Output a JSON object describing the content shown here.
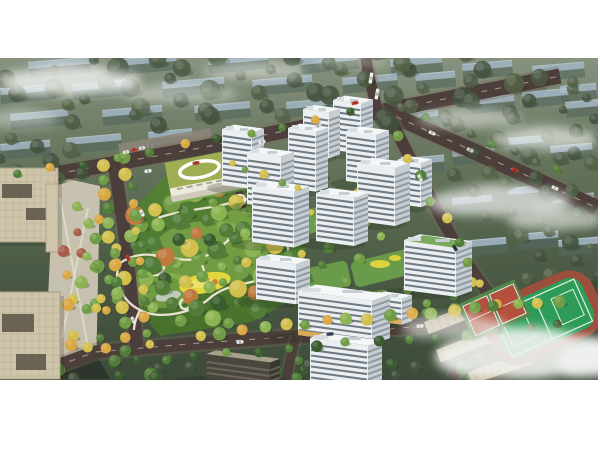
{
  "scene": {
    "description": "Aerial masterplan rendering: white residential towers around garden courtyards, central park with winding paths and yellow playground, kindergarten with green roof, beige office towers, sports field with red courts, tree-lined roads, faded background housing blocks and fog"
  },
  "canvas": {
    "w": 600,
    "h": 450,
    "bg": "#ffffff"
  },
  "render_frame": {
    "x": 0,
    "y": 58,
    "w": 598,
    "h": 322
  },
  "palette": {
    "fog": "#f2f4f2",
    "land": [
      "#87927f",
      "#64735a",
      "#4b5a44",
      "#3c4a39"
    ],
    "slabRoof": "#a7bccf",
    "slabRoofHi": "#d8e4ee",
    "slabFace": "#55675e",
    "road": "#4c3f3b",
    "curb": "#776a5b",
    "roadLine": "#e8ddca",
    "parkA": "#568336",
    "parkB": "#47702c",
    "lawn": "#7cae4b",
    "lawnHi": "#95c055",
    "path": "#efe9d9",
    "pond": "#c9cfc6",
    "playground": "#e4d63d",
    "playgroundHi": "#efe06a",
    "playOrange": "#d2823c",
    "towerFront": "#eceff1",
    "towerSide": "#c6cdd3",
    "towerRoof": "#f4f6f7",
    "stripe": "#414e59",
    "stripeSide": "#5a6670",
    "roofBox": "#d8dde1",
    "shop": "#d8a94f",
    "roofGarden": "#6da24b",
    "darkTop": "#a7a18c",
    "darkFront": "#4a463e",
    "darkSide": "#3a3731",
    "darkStripe": "#8d8674",
    "office": "#cfc5ab",
    "officeLine": "#b3a88d",
    "officeCourt": "#5f584a",
    "officeEdge": "#a89d83",
    "plaza": "#cdc6b4",
    "plazaPath": "#e7e2d4",
    "parking": "#8e867a",
    "schoolRoof": "#9fae52",
    "schoolWall": "#eeeadb",
    "schoolShade": "#cfcaba",
    "fieldGround": "#3d4c39",
    "fieldGreen": "#2e9b58",
    "fieldLine": "#dff0e4",
    "track": "#9c4f3c",
    "courtRed": "#b5503e",
    "courtGreen": "#56854a",
    "campusTop": "#c5b698",
    "campusFace": "#46423a",
    "shadow": "#1e2a1c",
    "darkStreet": "#2e352d",
    "trees": {
      "g1": "#3a5c2e",
      "g2": "#527d38",
      "g3": "#6f9c44",
      "g4": "#8cb452",
      "y": "#d2bf4e",
      "gold": "#d9a843",
      "o": "#bf7a3e",
      "r": "#a85c4a",
      "b1": "#44523e",
      "b2": "#556348",
      "b3": "#4d5c45"
    }
  },
  "bg_slabs": [
    [
      28,
      4,
      62
    ],
    [
      118,
      1,
      58
    ],
    [
      208,
      0,
      60
    ],
    [
      300,
      0,
      58
    ],
    [
      390,
      2,
      52
    ],
    [
      462,
      6,
      50
    ],
    [
      532,
      8,
      52
    ],
    [
      0,
      30,
      55
    ],
    [
      72,
      26,
      60
    ],
    [
      162,
      24,
      62
    ],
    [
      252,
      22,
      60
    ],
    [
      342,
      20,
      55
    ],
    [
      415,
      16,
      40
    ],
    [
      500,
      22,
      46
    ],
    [
      560,
      28,
      36
    ],
    [
      10,
      56,
      58
    ],
    [
      102,
      52,
      60
    ],
    [
      194,
      48,
      56
    ],
    [
      286,
      44,
      52
    ],
    [
      470,
      40,
      44
    ],
    [
      522,
      34,
      46
    ],
    [
      565,
      44,
      34
    ],
    [
      0,
      86,
      50
    ],
    [
      66,
      80,
      55
    ],
    [
      148,
      74,
      44
    ],
    [
      404,
      54,
      34
    ],
    [
      404,
      100,
      40
    ],
    [
      452,
      92,
      42
    ],
    [
      508,
      80,
      44
    ],
    [
      550,
      88,
      42
    ],
    [
      452,
      140,
      40
    ],
    [
      508,
      130,
      44
    ],
    [
      552,
      138,
      42
    ],
    [
      470,
      182,
      36
    ],
    [
      516,
      176,
      42
    ],
    [
      558,
      182,
      40
    ],
    [
      560,
      224,
      30
    ]
  ],
  "clouds": [
    [
      70,
      22,
      75,
      16,
      0.8
    ],
    [
      180,
      35,
      60,
      10,
      0.45
    ],
    [
      255,
      12,
      55,
      9,
      0.5
    ],
    [
      350,
      3,
      40,
      6,
      0.4
    ],
    [
      470,
      60,
      55,
      10,
      0.5
    ],
    [
      545,
      80,
      55,
      12,
      0.65
    ],
    [
      500,
      142,
      75,
      16,
      0.7
    ],
    [
      555,
      160,
      50,
      12,
      0.6
    ],
    [
      20,
      60,
      40,
      10,
      0.4
    ],
    [
      525,
      295,
      95,
      26,
      0.9
    ],
    [
      455,
      268,
      55,
      13,
      0.6
    ],
    [
      595,
      300,
      40,
      18,
      0.8
    ]
  ],
  "roads": [
    {
      "name": "top-road",
      "pts": [
        [
          0,
          126
        ],
        [
          200,
          90
        ],
        [
          383,
          53
        ],
        [
          470,
          36
        ],
        [
          560,
          18
        ]
      ],
      "w": 15,
      "dash": true
    },
    {
      "name": "northeast-road",
      "pts": [
        [
          383,
          53
        ],
        [
          480,
          96
        ],
        [
          597,
          150
        ]
      ],
      "w": 16,
      "dash": true
    },
    {
      "name": "north-exit-road",
      "pts": [
        [
          378,
          56
        ],
        [
          368,
          14
        ],
        [
          366,
          0
        ]
      ],
      "w": 11,
      "dash": false
    },
    {
      "name": "east-road",
      "pts": [
        [
          390,
          60
        ],
        [
          424,
          128
        ],
        [
          462,
          198
        ],
        [
          500,
          252
        ],
        [
          516,
          262
        ]
      ],
      "w": 12,
      "dash": false
    },
    {
      "name": "south-road",
      "pts": [
        [
          30,
          318
        ],
        [
          95,
          294
        ],
        [
          200,
          285
        ],
        [
          330,
          276
        ],
        [
          470,
          264
        ],
        [
          597,
          254
        ]
      ],
      "w": 13,
      "dash": true
    },
    {
      "name": "boulevard",
      "pts": [
        [
          114,
          104
        ],
        [
          124,
          170
        ],
        [
          137,
          290
        ]
      ],
      "w": 13,
      "dash": false
    },
    {
      "name": "side-street",
      "pts": [
        [
          296,
          278
        ],
        [
          286,
          321
        ]
      ],
      "w": 9,
      "dash": false
    },
    {
      "name": "southeast-street",
      "pts": [
        [
          500,
          252
        ],
        [
          470,
          290
        ],
        [
          452,
          321
        ]
      ],
      "w": 10,
      "dash": false
    },
    {
      "name": "entry-lane",
      "pts": [
        [
          232,
          100
        ],
        [
          243,
          150
        ]
      ],
      "w": 7,
      "dash": false
    }
  ],
  "park": {
    "poly": [
      [
        135,
        150
      ],
      [
        165,
        118
      ],
      [
        225,
        106
      ],
      [
        298,
        136
      ],
      [
        308,
        168
      ],
      [
        298,
        238
      ],
      [
        252,
        264
      ],
      [
        160,
        278
      ],
      [
        128,
        238
      ],
      [
        124,
        186
      ]
    ],
    "lawns": [
      [
        210,
        195,
        58,
        32
      ],
      [
        160,
        232,
        36,
        18
      ],
      [
        255,
        168,
        38,
        20
      ]
    ],
    "paths": [
      "M120,205 C150,185 172,208 200,200 C228,192 232,166 262,170 C286,174 296,194 282,210 C264,228 230,222 210,240 C192,256 158,262 140,252 C122,243 112,222 120,205 Z",
      "M158,160 C185,150 212,152 240,142",
      "M240,142 C262,138 270,150 264,168",
      "M200,200 C204,212 206,220 207,227",
      "M282,210 C292,218 300,226 306,238",
      "M140,252 C136,260 134,266 134,272"
    ],
    "plazas": [
      [
        155,
        208,
        9
      ],
      [
        265,
        170,
        7
      ],
      [
        240,
        142,
        5
      ],
      [
        185,
        246,
        5
      ],
      [
        292,
        208,
        4
      ]
    ],
    "pond": [
      168,
      238,
      13,
      5
    ],
    "playground": {
      "cx": 205,
      "cy": 225,
      "rx": 26,
      "ry": 10,
      "rot": -12
    }
  },
  "courtyards": [
    [
      262,
      108,
      64,
      22,
      -14
    ],
    [
      296,
      146,
      70,
      24,
      -14
    ],
    [
      270,
      210,
      80,
      26,
      -12
    ],
    [
      352,
      196,
      70,
      26,
      -14
    ],
    [
      330,
      236,
      60,
      20,
      -10
    ]
  ],
  "play_spots": [
    [
      380,
      206,
      10,
      4
    ],
    [
      395,
      200,
      6,
      3
    ]
  ],
  "towers": [
    {
      "x": 333,
      "y": 92,
      "w": 28,
      "h": 50,
      "d": 12
    },
    {
      "x": 303,
      "y": 97,
      "w": 26,
      "h": 46,
      "d": 11
    },
    {
      "x": 346,
      "y": 123,
      "w": 30,
      "h": 50,
      "d": 13
    },
    {
      "x": 222,
      "y": 127,
      "w": 30,
      "h": 56,
      "d": 12
    },
    {
      "x": 288,
      "y": 130,
      "w": 28,
      "h": 60,
      "d": 12
    },
    {
      "x": 247,
      "y": 146,
      "w": 34,
      "h": 52,
      "d": 13
    },
    {
      "x": 397,
      "y": 146,
      "w": 24,
      "h": 44,
      "d": 11
    },
    {
      "x": 357,
      "y": 163,
      "w": 38,
      "h": 58,
      "d": 15
    },
    {
      "x": 316,
      "y": 183,
      "w": 38,
      "h": 48,
      "d": 14
    },
    {
      "x": 252,
      "y": 184,
      "w": 42,
      "h": 56,
      "d": 15
    },
    {
      "x": 404,
      "y": 232,
      "w": 52,
      "h": 50,
      "d": 16,
      "roofGarden": true
    },
    {
      "x": 256,
      "y": 241,
      "w": 40,
      "h": 40,
      "d": 14
    },
    {
      "x": 374,
      "y": 263,
      "w": 28,
      "h": 26,
      "d": 10,
      "shops": true
    },
    {
      "x": 298,
      "y": 277,
      "w": 74,
      "h": 44,
      "d": 18,
      "shops": true
    },
    {
      "x": 206,
      "y": 320,
      "w": 64,
      "h": 24,
      "d": 10,
      "dark": true
    },
    {
      "x": 310,
      "y": 330,
      "w": 58,
      "h": 50,
      "d": 14,
      "shops": true
    }
  ],
  "offices": [
    {
      "x": -8,
      "y": 110,
      "w": 66,
      "h": 74,
      "courts": [
        [
          10,
          16,
          30,
          14
        ],
        [
          34,
          40,
          22,
          12
        ]
      ]
    },
    {
      "x": -10,
      "y": 234,
      "w": 70,
      "h": 87,
      "courts": [
        [
          12,
          22,
          32,
          18
        ],
        [
          26,
          62,
          30,
          16
        ]
      ]
    }
  ],
  "office_wing": {
    "x": 46,
    "y": 126,
    "w": 12,
    "h": 68
  },
  "plaza": {
    "poly": [
      [
        54,
        118
      ],
      [
        100,
        128
      ],
      [
        96,
        318
      ],
      [
        44,
        321
      ]
    ],
    "paths": [
      [
        [
          60,
          140
        ],
        [
          90,
          300
        ]
      ],
      [
        [
          88,
          150
        ],
        [
          62,
          280
        ]
      ]
    ]
  },
  "dark_street_corner": [
    [
      0,
      318
    ],
    [
      96,
      296
    ],
    [
      110,
      321
    ],
    [
      0,
      321
    ]
  ],
  "parking_lot": {
    "poly": [
      [
        118,
        86
      ],
      [
        210,
        70
      ],
      [
        214,
        92
      ],
      [
        122,
        108
      ]
    ]
  },
  "school": {
    "cx": 213,
    "cy": 118,
    "rot": -11
  },
  "field_ground": [
    [
      412,
      252
    ],
    [
      597,
      222
    ],
    [
      597,
      321
    ],
    [
      440,
      321
    ]
  ],
  "sports_field": {
    "cx": 543,
    "cy": 260,
    "rot": -24,
    "w": 118,
    "h": 70
  },
  "basketball_courts": {
    "cx": 494,
    "cy": 252,
    "rot": -24,
    "w": 62,
    "h": 40
  },
  "campus_buildings": [
    {
      "x": 424,
      "y": 264,
      "len": 80,
      "rot": -21
    },
    {
      "x": 436,
      "y": 292,
      "len": 92,
      "rot": -21
    },
    {
      "x": 468,
      "y": 314,
      "len": 62,
      "rot": -19
    }
  ],
  "tree_clusters": [
    {
      "cx": 290,
      "cy": 32,
      "rx": 295,
      "ry": 46,
      "n": 60,
      "r": [
        5,
        11
      ],
      "c": [
        "b1",
        "b2",
        "b3"
      ],
      "o": 0.85
    },
    {
      "cx": 525,
      "cy": 118,
      "rx": 80,
      "ry": 62,
      "n": 20,
      "r": [
        5,
        10
      ],
      "c": [
        "b1",
        "b2",
        "b3"
      ],
      "o": 0.85
    },
    {
      "cx": 565,
      "cy": 205,
      "rx": 38,
      "ry": 42,
      "n": 10,
      "r": [
        4,
        9
      ],
      "c": [
        "b1",
        "b2"
      ],
      "o": 0.9
    },
    {
      "cx": 35,
      "cy": 105,
      "rx": 55,
      "ry": 35,
      "n": 10,
      "r": [
        5,
        9
      ],
      "c": [
        "b1",
        "b2"
      ],
      "o": 0.85
    },
    {
      "cx": 210,
      "cy": 195,
      "rx": 92,
      "ry": 72,
      "n": 70,
      "r": [
        4,
        10
      ],
      "c": [
        "g2",
        "g3",
        "g1",
        "g4",
        "y",
        "g2",
        "g3",
        "o",
        "g2",
        "g4"
      ],
      "o": 1
    },
    {
      "cx": 310,
      "cy": 170,
      "rx": 80,
      "ry": 60,
      "n": 26,
      "r": [
        3,
        6
      ],
      "c": [
        "g3",
        "g4",
        "y",
        "g2"
      ],
      "o": 1
    },
    {
      "cx": 440,
      "cy": 235,
      "rx": 55,
      "ry": 30,
      "n": 12,
      "r": [
        4,
        7
      ],
      "c": [
        "g2",
        "g3",
        "y"
      ],
      "o": 1
    },
    {
      "cx": 250,
      "cy": 312,
      "rx": 250,
      "ry": 12,
      "n": 30,
      "r": [
        4,
        7
      ],
      "c": [
        "g1",
        "b1",
        "g2"
      ],
      "o": 0.95
    },
    {
      "cx": 80,
      "cy": 225,
      "rx": 20,
      "ry": 80,
      "n": 16,
      "r": [
        4,
        7
      ],
      "c": [
        "g4",
        "y",
        "r",
        "g3",
        "gold"
      ],
      "o": 1
    },
    {
      "cx": 105,
      "cy": 220,
      "rx": 14,
      "ry": 85,
      "n": 14,
      "r": [
        4,
        6
      ],
      "c": [
        "g3",
        "y",
        "g2",
        "gold"
      ],
      "o": 1
    },
    {
      "cx": 500,
      "cy": 290,
      "rx": 70,
      "ry": 25,
      "n": 12,
      "r": [
        4,
        7
      ],
      "c": [
        "g1",
        "g2",
        "b1"
      ],
      "o": 0.95
    },
    {
      "cx": 585,
      "cy": 60,
      "rx": 30,
      "ry": 40,
      "n": 8,
      "r": [
        4,
        8
      ],
      "c": [
        "b1",
        "b2"
      ],
      "o": 0.8
    }
  ],
  "tree_rows": [
    {
      "a": [
        102,
        108
      ],
      "b": [
        126,
        294
      ],
      "n": 14,
      "r": [
        5,
        7
      ],
      "c": [
        "y",
        "g3",
        "gold",
        "g2",
        "g4"
      ]
    },
    {
      "a": [
        126,
        102
      ],
      "b": [
        150,
        288
      ],
      "n": 14,
      "r": [
        4,
        7
      ],
      "c": [
        "g3",
        "y",
        "g2",
        "gold"
      ]
    },
    {
      "a": [
        200,
        276
      ],
      "b": [
        560,
        242
      ],
      "n": 18,
      "r": [
        5,
        7
      ],
      "c": [
        "y",
        "g3",
        "gold",
        "g4"
      ]
    },
    {
      "a": [
        135,
        304
      ],
      "b": [
        560,
        268
      ],
      "n": 15,
      "r": [
        4,
        6
      ],
      "c": [
        "g1",
        "g2",
        "g1",
        "g3"
      ]
    },
    {
      "a": [
        398,
        78
      ],
      "b": [
        492,
        246
      ],
      "n": 9,
      "r": [
        4,
        6
      ],
      "c": [
        "g3",
        "y",
        "g2"
      ]
    },
    {
      "a": [
        15,
        118
      ],
      "b": [
        350,
        56
      ],
      "n": 11,
      "r": [
        4,
        5
      ],
      "c": [
        "g2",
        "gold",
        "g1",
        "g3"
      ]
    },
    {
      "a": [
        400,
        48
      ],
      "b": [
        560,
        112
      ],
      "n": 8,
      "r": [
        4,
        5
      ],
      "c": [
        "b2",
        "g2",
        "b1"
      ]
    },
    {
      "a": [
        230,
        104
      ],
      "b": [
        300,
        132
      ],
      "n": 5,
      "r": [
        3,
        5
      ],
      "c": [
        "y",
        "g3"
      ]
    }
  ],
  "cars": [
    [
      148,
      113,
      -10,
      "#eef0f0"
    ],
    [
      196,
      105,
      -10,
      "#b94039"
    ],
    [
      262,
      84,
      -11,
      "#e7e9ea"
    ],
    [
      318,
      68,
      -11,
      "#d8dadb"
    ],
    [
      355,
      45,
      -11,
      "#c23b35"
    ],
    [
      371,
      20,
      -80,
      "#f3f4f4",
      11
    ],
    [
      377,
      36,
      -80,
      "#eeefef",
      11
    ],
    [
      432,
      75,
      24,
      "#e8eaea"
    ],
    [
      470,
      92,
      24,
      "#cdd2d6"
    ],
    [
      515,
      112,
      24,
      "#c0392b"
    ],
    [
      555,
      130,
      24,
      "#e8eaea"
    ],
    [
      420,
      120,
      62,
      "#e8e8e8"
    ],
    [
      455,
      190,
      60,
      "#2e3d4a"
    ],
    [
      240,
      284,
      -4,
      "#eceeee"
    ],
    [
      330,
      276,
      -4,
      "#37475a"
    ],
    [
      420,
      268,
      -3,
      "#e8e8e8"
    ],
    [
      142,
      155,
      63,
      "#f0f0f0"
    ],
    [
      128,
      200,
      64,
      "#c0392b"
    ],
    [
      133,
      262,
      64,
      "#e8e8e8"
    ],
    [
      126,
      94,
      -10,
      "#e8e8e8",
      6
    ],
    [
      134,
      92,
      -10,
      "#b94039",
      6
    ],
    [
      142,
      90,
      -10,
      "#dfe2e4",
      6
    ],
    [
      150,
      88,
      -10,
      "#8a929a",
      6
    ]
  ]
}
